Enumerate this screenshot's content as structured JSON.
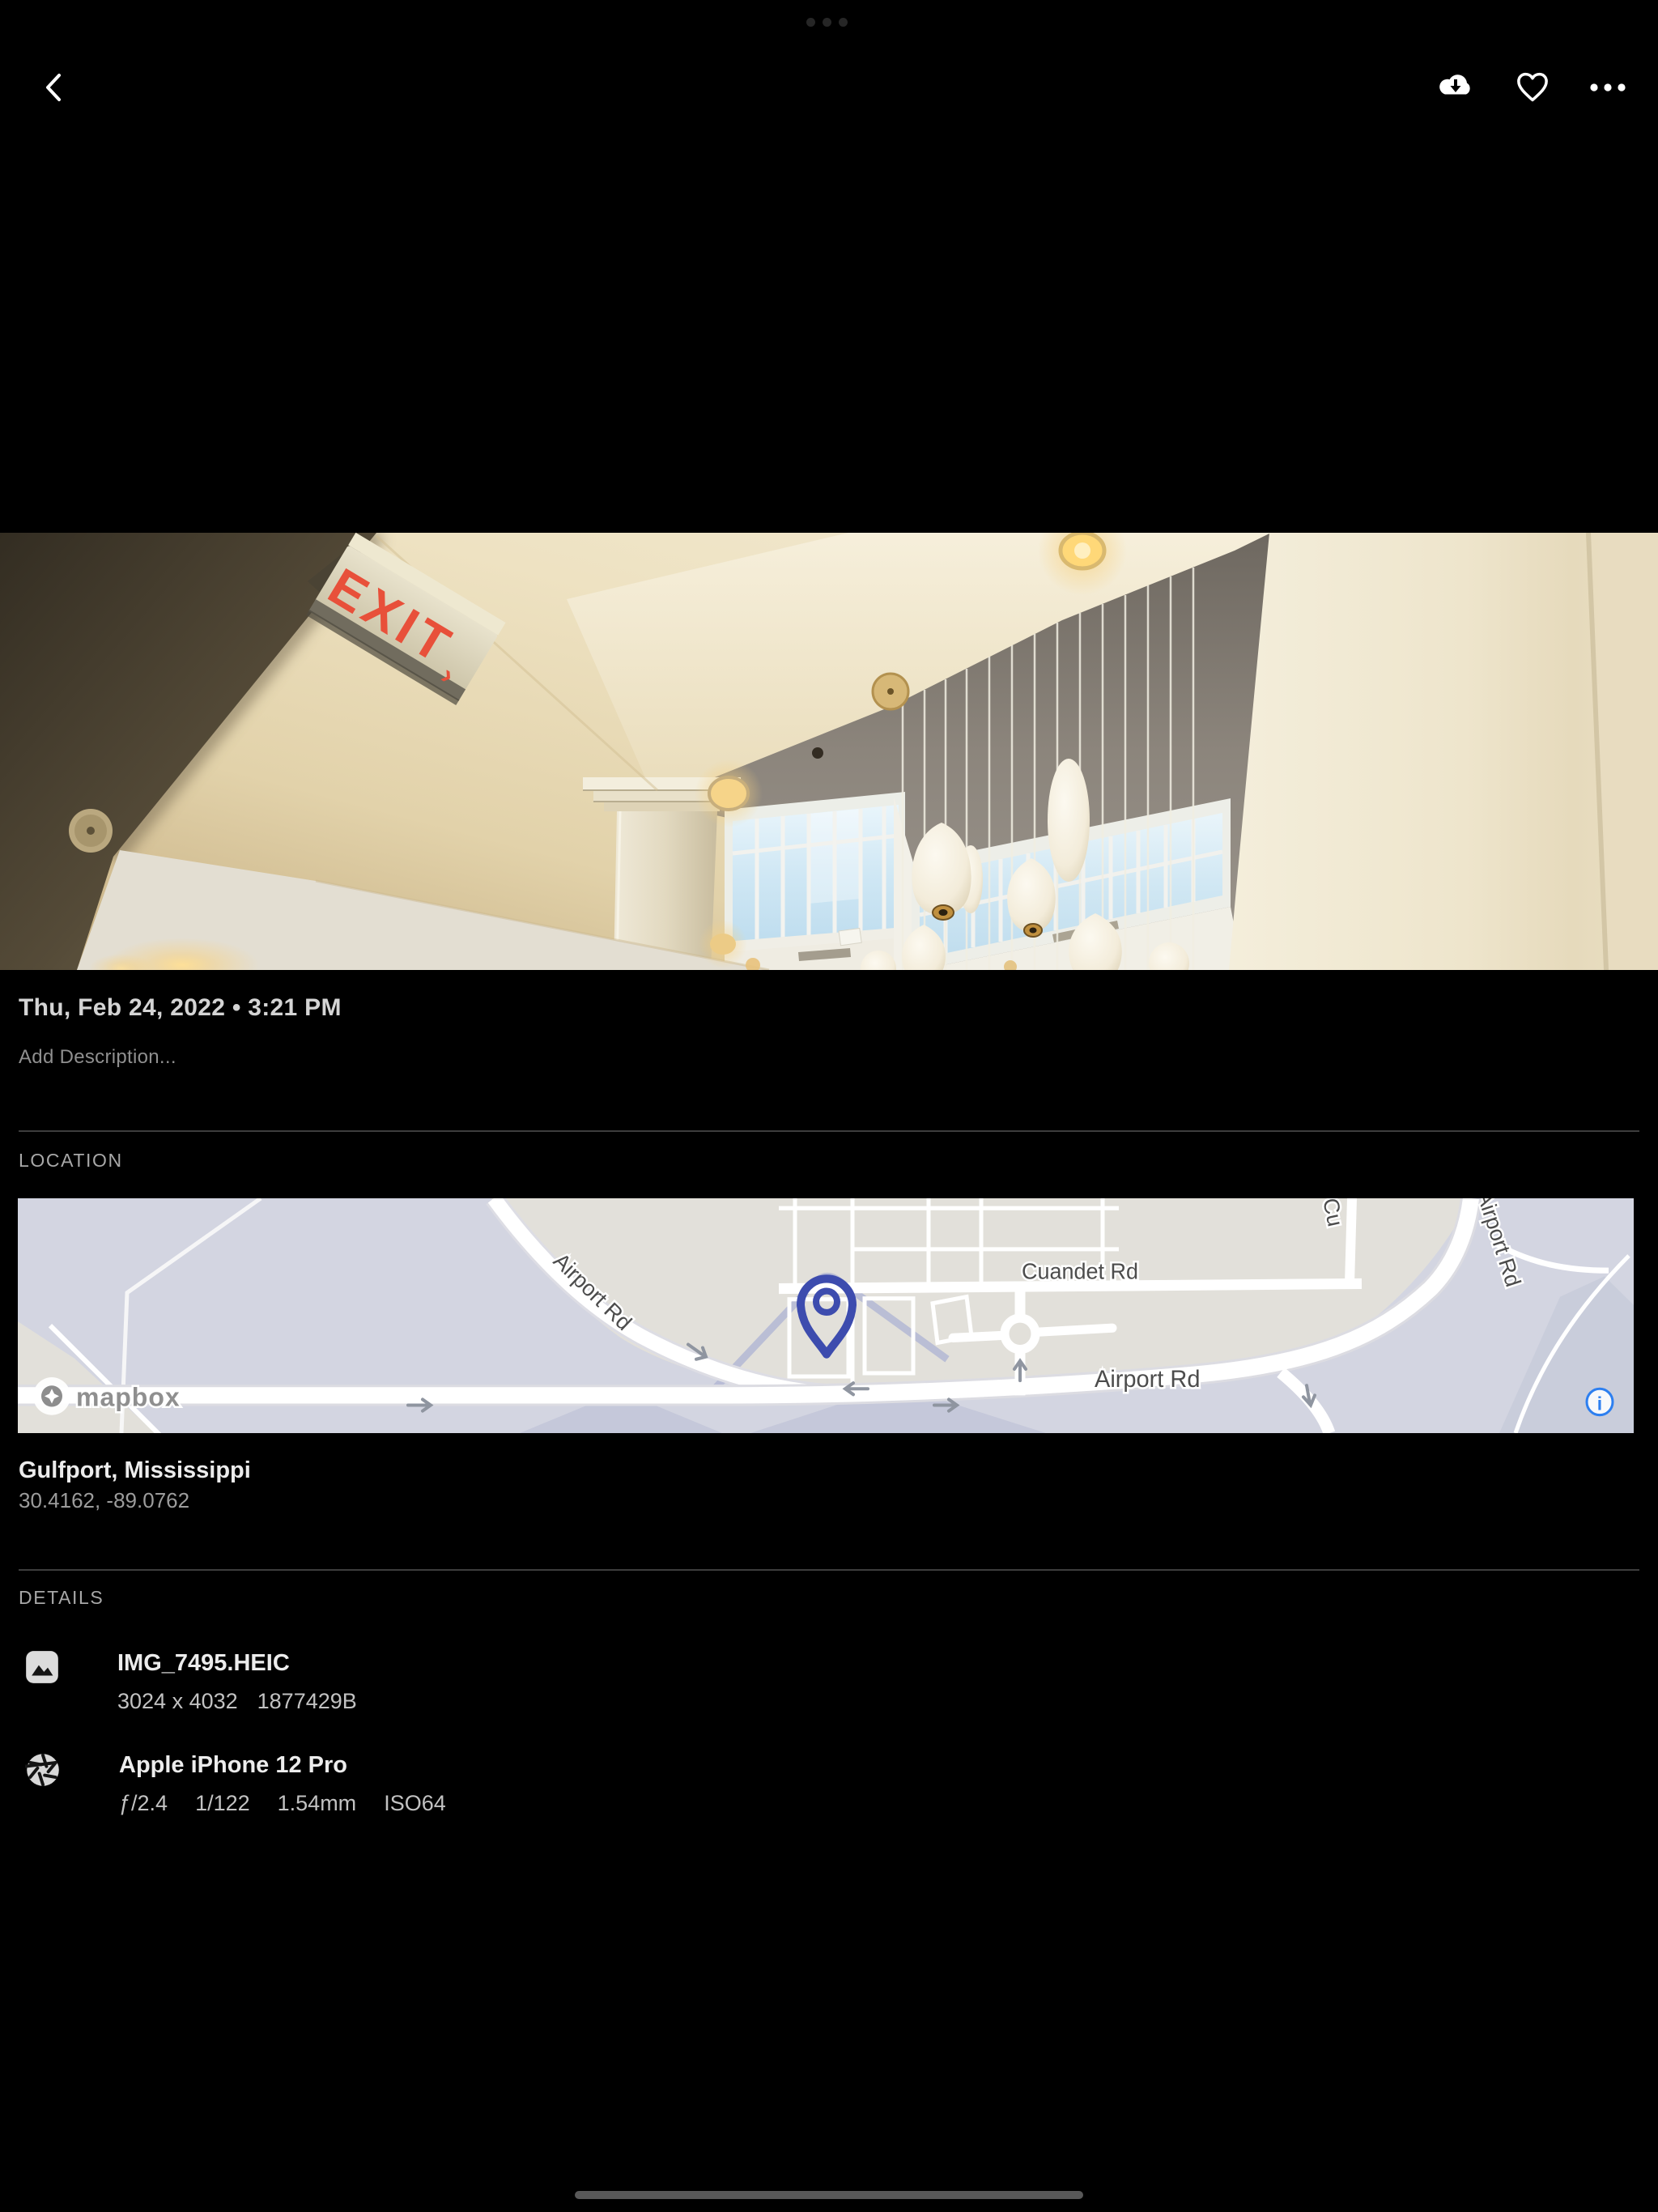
{
  "top_bar": {
    "icons": {
      "back": "chevron-left",
      "download": "cloud-arrow-down",
      "favorite": "heart-outline",
      "more": "ellipsis-horizontal"
    }
  },
  "photo": {
    "exit_sign_text": "EXIT",
    "exit_sign_arrow": "›"
  },
  "meta": {
    "date": "Thu, Feb 24, 2022 • 3:21 PM",
    "description_placeholder": "Add Description..."
  },
  "location": {
    "header": "LOCATION",
    "place": "Gulfport, Mississippi",
    "coordinates": "30.4162, -89.0762",
    "map": {
      "attribution": "mapbox",
      "info_glyph": "i",
      "labels": [
        {
          "text": "Airport Rd"
        },
        {
          "text": "Cuandet Rd"
        },
        {
          "text": "Airport Rd"
        },
        {
          "text": "Airport Rd"
        },
        {
          "text": "Cu"
        }
      ]
    }
  },
  "details": {
    "header": "DETAILS",
    "file": {
      "name": "IMG_7495.HEIC",
      "info": [
        "3024 x 4032",
        "1877429B"
      ]
    },
    "camera": {
      "name": "Apple iPhone 12 Pro",
      "info": [
        "ƒ/2.4",
        "1/122",
        "1.54mm",
        "ISO64"
      ]
    }
  }
}
